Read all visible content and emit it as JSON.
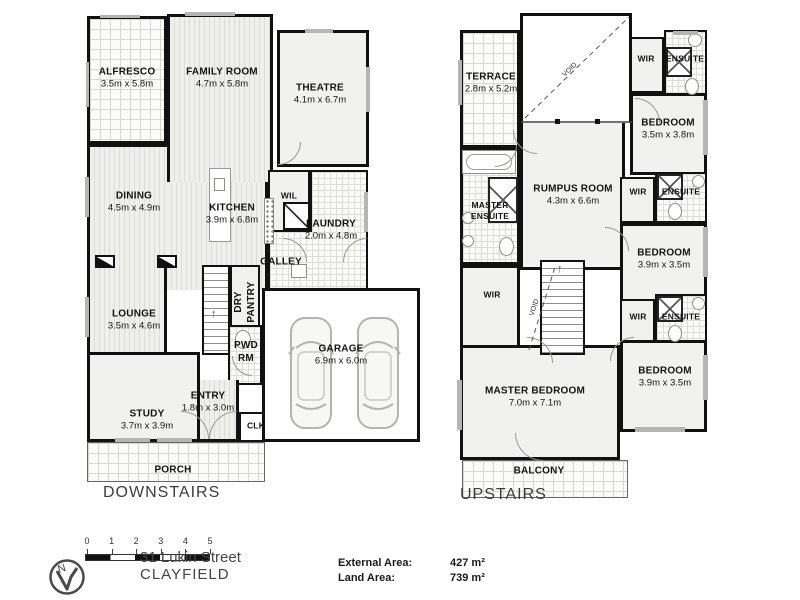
{
  "colors": {
    "wall": "#111111",
    "window_marker": "#b5b5b3",
    "text": "#141414"
  },
  "down": {
    "title": "DOWNSTAIRS",
    "rooms": {
      "alfresco": {
        "name": "ALFRESCO",
        "dims": "3.5m x 5.8m"
      },
      "family": {
        "name": "FAMILY ROOM",
        "dims": "4.7m x 5.8m"
      },
      "theatre": {
        "name": "THEATRE",
        "dims": "4.1m x 6.7m"
      },
      "dining": {
        "name": "DINING",
        "dims": "4.5m x 4.9m"
      },
      "kitchen": {
        "name": "KITCHEN",
        "dims": "3.9m x 6.8m"
      },
      "wil": {
        "name": "WIL"
      },
      "laundry": {
        "name": "LAUNDRY",
        "dims": "2.0m x 4.8m"
      },
      "galley": {
        "name": "GALLEY"
      },
      "lounge": {
        "name": "LOUNGE",
        "dims": "3.5m x 4.6m"
      },
      "dry_pantry": {
        "name": "DRY PANTRY"
      },
      "pwd_rm": {
        "name": "PWD RM"
      },
      "entry": {
        "name": "ENTRY",
        "dims": "1.8m x 3.0m"
      },
      "study": {
        "name": "STUDY",
        "dims": "3.7m x 3.9m"
      },
      "clk": {
        "name": "CLK"
      },
      "garage": {
        "name": "GARAGE",
        "dims": "6.9m x 6.0m"
      },
      "porch": {
        "name": "PORCH"
      }
    }
  },
  "up": {
    "title": "UPSTAIRS",
    "rooms": {
      "terrace": {
        "name": "TERRACE",
        "dims": "2.8m x 5.2m"
      },
      "void_top": {
        "name": "VOID"
      },
      "void_stairs": {
        "name": "VOID"
      },
      "wir_top": {
        "name": "WIR"
      },
      "ensuite_top": {
        "name": "ENSUITE"
      },
      "bedroom_top": {
        "name": "BEDROOM",
        "dims": "3.5m x 3.8m"
      },
      "rumpus": {
        "name": "RUMPUS ROOM",
        "dims": "4.3m x 6.6m"
      },
      "master_ensuite": {
        "name": "MASTER ENSUITE"
      },
      "wir_mid": {
        "name": "WIR"
      },
      "ensuite_mid": {
        "name": "ENSUITE"
      },
      "bedroom_mid": {
        "name": "BEDROOM",
        "dims": "3.9m x 3.5m"
      },
      "wir_left": {
        "name": "WIR"
      },
      "wir_bottom": {
        "name": "WIR"
      },
      "ensuite_bottom": {
        "name": "ENSUITE"
      },
      "bedroom_bottom": {
        "name": "BEDROOM",
        "dims": "3.9m x 3.5m"
      },
      "master_bedroom": {
        "name": "MASTER BEDROOM",
        "dims": "7.0m x 7.1m"
      },
      "balcony": {
        "name": "BALCONY"
      }
    }
  },
  "legend": {
    "scale_ticks": [
      "0",
      "1",
      "2",
      "3",
      "4",
      "5"
    ],
    "north_label": "N",
    "address_line1": "31 Lukin Street",
    "address_line2": "CLAYFIELD",
    "external_area_label": "External  Area:",
    "external_area_value": "427 m²",
    "land_area_label": "Land  Area:",
    "land_area_value": "739 m²"
  },
  "icons": {
    "up_arrow": "↑"
  }
}
